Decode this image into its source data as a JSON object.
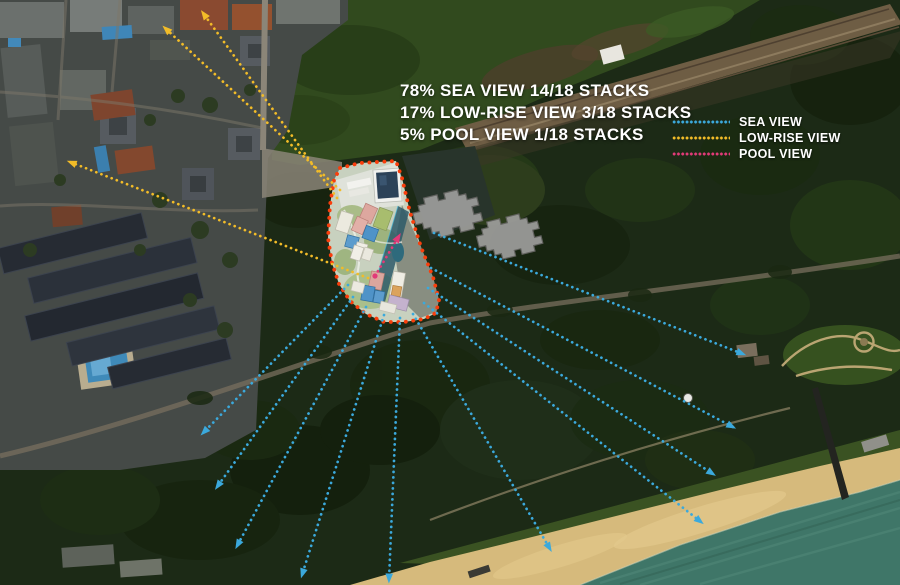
{
  "title": "Sea view analysis aerial map",
  "stats": {
    "lines": [
      "78% SEA VIEW 14/18 STACKS",
      "17% LOW-RISE VIEW 3/18 STACKS",
      "5% POOL VIEW 1/18 STACKS"
    ]
  },
  "legend": {
    "items": [
      {
        "id": "sea-view",
        "label": "SEA VIEW",
        "color": "#3BA9DC"
      },
      {
        "id": "low-rise-view",
        "label": "LOW-RISE VIEW",
        "color": "#F2BC28"
      },
      {
        "id": "pool-view",
        "label": "POOL VIEW",
        "color": "#E23A78"
      }
    ]
  },
  "diagram": {
    "site_boundary": {
      "color": "#F93E0C",
      "points": [
        [
          340,
          168
        ],
        [
          360,
          163
        ],
        [
          396,
          161
        ],
        [
          402,
          178
        ],
        [
          410,
          212
        ],
        [
          421,
          247
        ],
        [
          433,
          277
        ],
        [
          439,
          300
        ],
        [
          436,
          313
        ],
        [
          424,
          319
        ],
        [
          404,
          322
        ],
        [
          384,
          322
        ],
        [
          366,
          314
        ],
        [
          350,
          301
        ],
        [
          339,
          284
        ],
        [
          332,
          263
        ],
        [
          328,
          238
        ],
        [
          330,
          205
        ],
        [
          334,
          180
        ]
      ]
    },
    "arrows": [
      {
        "type": "sea-view",
        "from": [
          348,
          285
        ],
        "to": [
          203,
          433
        ]
      },
      {
        "type": "sea-view",
        "from": [
          353,
          297
        ],
        "to": [
          217,
          487
        ]
      },
      {
        "type": "sea-view",
        "from": [
          366,
          307
        ],
        "to": [
          237,
          546
        ]
      },
      {
        "type": "sea-view",
        "from": [
          384,
          315
        ],
        "to": [
          302,
          575
        ]
      },
      {
        "type": "sea-view",
        "from": [
          400,
          318
        ],
        "to": [
          389,
          580
        ]
      },
      {
        "type": "sea-view",
        "from": [
          413,
          314
        ],
        "to": [
          550,
          549
        ]
      },
      {
        "type": "sea-view",
        "from": [
          424,
          303
        ],
        "to": [
          701,
          522
        ]
      },
      {
        "type": "sea-view",
        "from": [
          428,
          288
        ],
        "to": [
          713,
          474
        ]
      },
      {
        "type": "sea-view",
        "from": [
          431,
          268
        ],
        "to": [
          733,
          427
        ]
      },
      {
        "type": "sea-view",
        "from": [
          434,
          233
        ],
        "to": [
          743,
          354
        ]
      },
      {
        "type": "low-rise-view",
        "from": [
          340,
          190
        ],
        "to": [
          165,
          28
        ]
      },
      {
        "type": "low-rise-view",
        "from": [
          337,
          198
        ],
        "to": [
          203,
          13
        ]
      },
      {
        "type": "low-rise-view",
        "from": [
          368,
          278
        ],
        "to": [
          70,
          162
        ]
      },
      {
        "type": "pool-view",
        "from": [
          375,
          276
        ],
        "to": [
          399,
          236
        ]
      }
    ],
    "neighbor_buildings": {
      "color": "#9D9D9B",
      "positions": [
        [
          447,
          214
        ],
        [
          509,
          237
        ]
      ],
      "rotation": -14
    }
  }
}
